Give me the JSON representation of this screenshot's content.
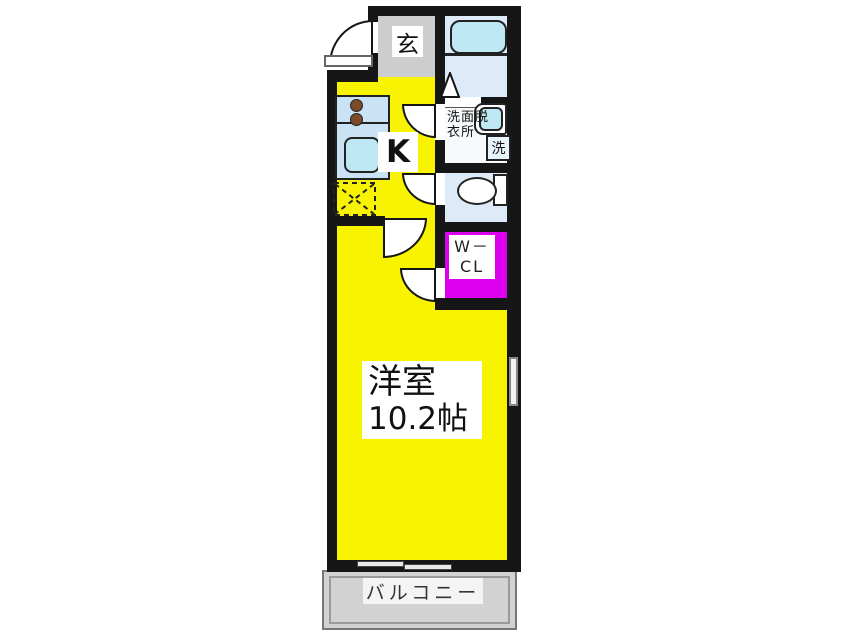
{
  "plan": {
    "entrance": {
      "label": "玄"
    },
    "kitchen": {
      "label": "K"
    },
    "washroom": {
      "label": "洗面脱衣所"
    },
    "washing_machine": {
      "label": "洗"
    },
    "walk_in_closet": {
      "label_line1": "W－",
      "label_line2": "CL"
    },
    "western_room": {
      "name": "洋室",
      "size": "10.2帖"
    },
    "balcony": {
      "label": "バルコニー"
    }
  },
  "colors": {
    "wall": "#161616",
    "room_yellow": "#F8F301",
    "closet_magenta": "#DD00EE",
    "entrance_gray": "#CDCDCD",
    "balcony_gray": "#D2D2D2",
    "wet_room_blue": "#DCEBF7",
    "fixture_cyan": "#BEE8F3",
    "counter_blue": "#C9E2F4",
    "burner_brown": "#7B4A2B"
  }
}
